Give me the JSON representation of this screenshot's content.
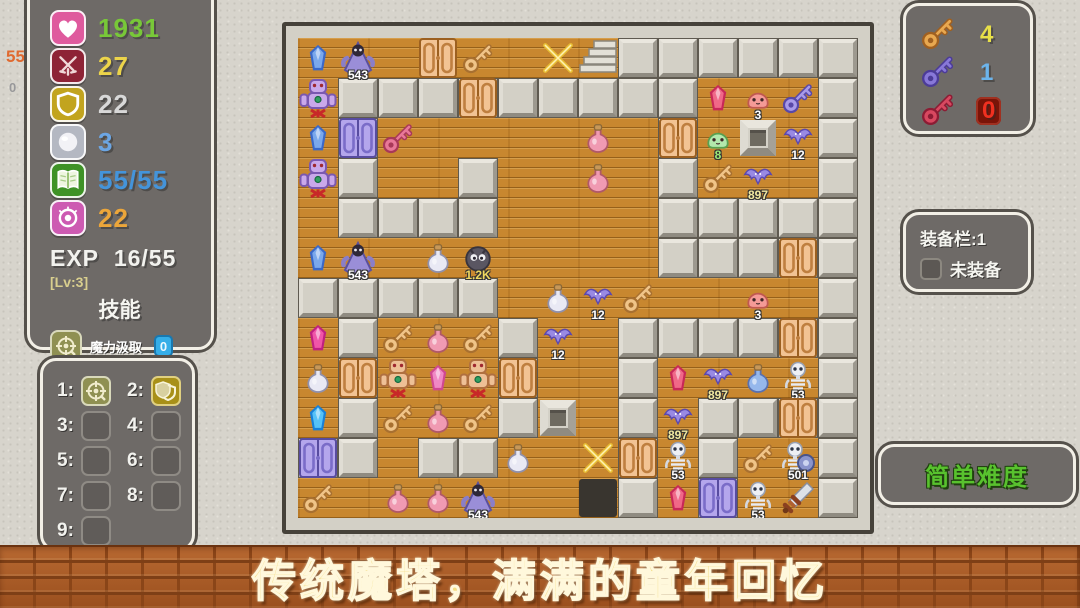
{
  "edge_marks": {
    "attack_up": "55",
    "counter": "0"
  },
  "stats_panel": {
    "rows": [
      {
        "name": "hp",
        "icon": "heart-icon",
        "bg": "#df5a9e",
        "value": "1931",
        "color": "#78c838"
      },
      {
        "name": "attack",
        "icon": "sword-icon",
        "bg": "#8e2336",
        "value": "27",
        "color": "#ecd44a"
      },
      {
        "name": "defense",
        "icon": "shield-icon",
        "bg": "#c2a41e",
        "value": "22",
        "color": "#d8d8d8"
      },
      {
        "name": "orb",
        "icon": "orb-icon",
        "bg": "#b4b8c2",
        "value": "3",
        "color": "#6ca6e4"
      },
      {
        "name": "exp-book",
        "icon": "book-icon",
        "bg": "#3e9226",
        "value": "55/55",
        "color": "#4494da"
      },
      {
        "name": "magic",
        "icon": "magic-icon",
        "bg": "#cd5ab2",
        "value": "22",
        "color": "#eca63a"
      }
    ],
    "exp_label": "EXP",
    "exp_value": "16/55",
    "level": "[Lv:3]",
    "skills_title": "技能",
    "skill_name": "魔力汲取",
    "skill_count": "0",
    "status_label": "状态:"
  },
  "hotbar": {
    "slots": [
      {
        "num": "1:",
        "icon": "skill-drain-icon"
      },
      {
        "num": "2:",
        "icon": "shield-stack-icon"
      },
      {
        "num": "3:"
      },
      {
        "num": "4:"
      },
      {
        "num": "5:"
      },
      {
        "num": "6:"
      },
      {
        "num": "7:"
      },
      {
        "num": "8:"
      },
      {
        "num": "9:"
      }
    ]
  },
  "key_panel": {
    "rows": [
      {
        "name": "yellow-key",
        "count": "4",
        "count_color": "#e8e048"
      },
      {
        "name": "blue-key",
        "count": "1",
        "count_color": "#6cb4ec"
      },
      {
        "name": "red-key",
        "count": "0",
        "count_color": "#f03020",
        "badge": true
      }
    ]
  },
  "equip_panel": {
    "title": "装备栏:1",
    "empty_label": "未装备"
  },
  "difficulty_button": {
    "label": "简单难度"
  },
  "banner": {
    "text": "传统魔塔，满满的童年回忆"
  },
  "map": {
    "cols": 14,
    "rows": 12,
    "tile": 40,
    "walls": [
      "........######",
      ".#########...#",
      ".#.......#...#",
      ".#..#....#...#",
      ".####....#####",
      ".........#####",
      "#####........#",
      ".#...#..######",
      ".#...#..#....#",
      ".#...#..#.####",
      "##.##...#.#..#",
      "........#.#..#"
    ],
    "items": [
      {
        "type": "gem-blue",
        "col": 0,
        "row": 0
      },
      {
        "type": "monster-robe",
        "col": 1,
        "row": 0,
        "label": "543"
      },
      {
        "type": "door-orange",
        "col": 3,
        "row": 0
      },
      {
        "type": "key-tan",
        "col": 4,
        "row": 0
      },
      {
        "type": "sparkle",
        "col": 6,
        "row": 0
      },
      {
        "type": "stairs",
        "col": 7,
        "row": 0
      },
      {
        "type": "golem-purple",
        "col": 0,
        "row": 1
      },
      {
        "type": "door-orange",
        "col": 4,
        "row": 1
      },
      {
        "type": "gem-red",
        "col": 10,
        "row": 1
      },
      {
        "type": "slime-pink",
        "col": 11,
        "row": 1,
        "label": "3"
      },
      {
        "type": "key-blue",
        "col": 12,
        "row": 1
      },
      {
        "type": "gem-blue",
        "col": 0,
        "row": 2
      },
      {
        "type": "door-purple",
        "col": 1,
        "row": 2
      },
      {
        "type": "key-red",
        "col": 2,
        "row": 2
      },
      {
        "type": "potion-pink",
        "col": 7,
        "row": 2
      },
      {
        "type": "door-orange",
        "col": 9,
        "row": 2
      },
      {
        "type": "slime-green",
        "col": 10,
        "row": 2,
        "label": "8",
        "label_color": "#9ae878"
      },
      {
        "type": "block",
        "col": 11,
        "row": 2
      },
      {
        "type": "bat-purple",
        "col": 12,
        "row": 2,
        "label": "12"
      },
      {
        "type": "golem-purple",
        "col": 0,
        "row": 3
      },
      {
        "type": "potion-pink",
        "col": 7,
        "row": 3
      },
      {
        "type": "key-tan",
        "col": 10,
        "row": 3
      },
      {
        "type": "bat-purple",
        "col": 11,
        "row": 3,
        "label": "897",
        "label_color": "#f0e8a0"
      },
      {
        "type": "gem-blue",
        "col": 0,
        "row": 5
      },
      {
        "type": "monster-robe",
        "col": 1,
        "row": 5,
        "label": "543"
      },
      {
        "type": "potion-white",
        "col": 3,
        "row": 5
      },
      {
        "type": "blob-dark",
        "col": 4,
        "row": 5,
        "label": "1.2K",
        "label_color": "#f0d860"
      },
      {
        "type": "door-orange",
        "col": 12,
        "row": 5
      },
      {
        "type": "potion-white",
        "col": 6,
        "row": 6
      },
      {
        "type": "bat-purple",
        "col": 7,
        "row": 6,
        "label": "12"
      },
      {
        "type": "key-tan",
        "col": 8,
        "row": 6
      },
      {
        "type": "slime-pink",
        "col": 11,
        "row": 6,
        "label": "3"
      },
      {
        "type": "gem-magenta",
        "col": 0,
        "row": 7
      },
      {
        "type": "key-tan",
        "col": 2,
        "row": 7
      },
      {
        "type": "potion-pink",
        "col": 3,
        "row": 7
      },
      {
        "type": "key-tan",
        "col": 4,
        "row": 7
      },
      {
        "type": "bat-purple",
        "col": 6,
        "row": 7,
        "label": "12"
      },
      {
        "type": "door-orange",
        "col": 12,
        "row": 7
      },
      {
        "type": "potion-white",
        "col": 0,
        "row": 8
      },
      {
        "type": "door-orange",
        "col": 1,
        "row": 8
      },
      {
        "type": "golem-tan",
        "col": 2,
        "row": 8
      },
      {
        "type": "gem-pink",
        "col": 3,
        "row": 8
      },
      {
        "type": "golem-tan",
        "col": 4,
        "row": 8
      },
      {
        "type": "door-orange",
        "col": 5,
        "row": 8
      },
      {
        "type": "gem-red",
        "col": 9,
        "row": 8
      },
      {
        "type": "bat-purple",
        "col": 10,
        "row": 8,
        "label": "897",
        "label_color": "#f0e8a0"
      },
      {
        "type": "potion-blue",
        "col": 11,
        "row": 8
      },
      {
        "type": "skeleton",
        "col": 12,
        "row": 8,
        "label": "53"
      },
      {
        "type": "gem-cyan",
        "col": 0,
        "row": 9
      },
      {
        "type": "key-tan",
        "col": 2,
        "row": 9
      },
      {
        "type": "potion-pink",
        "col": 3,
        "row": 9
      },
      {
        "type": "key-tan",
        "col": 4,
        "row": 9
      },
      {
        "type": "block",
        "col": 6,
        "row": 9
      },
      {
        "type": "bat-purple",
        "col": 9,
        "row": 9,
        "label": "897",
        "label_color": "#f0e8a0"
      },
      {
        "type": "door-orange",
        "col": 12,
        "row": 9
      },
      {
        "type": "door-purple",
        "col": 0,
        "row": 10
      },
      {
        "type": "potion-white",
        "col": 5,
        "row": 10
      },
      {
        "type": "sparkle",
        "col": 7,
        "row": 10
      },
      {
        "type": "door-orange",
        "col": 8,
        "row": 10
      },
      {
        "type": "skeleton",
        "col": 9,
        "row": 10,
        "label": "53"
      },
      {
        "type": "key-tan",
        "col": 11,
        "row": 10
      },
      {
        "type": "skeleton-shield",
        "col": 12,
        "row": 10,
        "label": "501"
      },
      {
        "type": "key-tan",
        "col": 0,
        "row": 11
      },
      {
        "type": "potion-pink",
        "col": 2,
        "row": 11
      },
      {
        "type": "potion-pink",
        "col": 3,
        "row": 11
      },
      {
        "type": "monster-robe",
        "col": 4,
        "row": 11,
        "label": "543"
      },
      {
        "type": "hero",
        "col": 7,
        "row": 11
      },
      {
        "type": "gem-red",
        "col": 9,
        "row": 11
      },
      {
        "type": "door-purple",
        "col": 10,
        "row": 11
      },
      {
        "type": "skeleton",
        "col": 11,
        "row": 11,
        "label": "53"
      },
      {
        "type": "sword",
        "col": 12,
        "row": 11
      }
    ]
  }
}
